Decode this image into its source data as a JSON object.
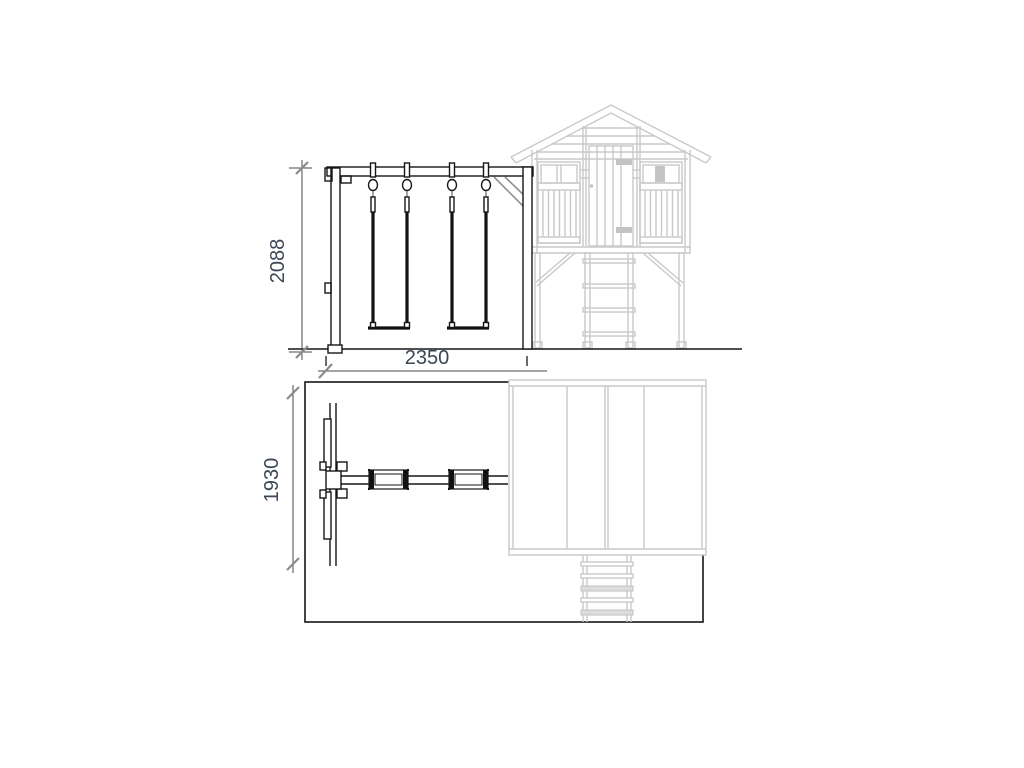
{
  "drawing": {
    "dimensions": {
      "elevation_height": {
        "value": "2088",
        "unit_hint": "mm",
        "orientation": "vertical"
      },
      "elevation_width": {
        "value": "2350",
        "unit_hint": "mm",
        "orientation": "horizontal"
      },
      "plan_depth": {
        "value": "1930",
        "unit_hint": "mm",
        "orientation": "vertical"
      }
    },
    "colors": {
      "structure_line": "#161616",
      "playhouse_line": "#c9c9c9",
      "corner_brace": "#8f8f8f",
      "dimension_text": "#3b4754",
      "dimension_line": "#4a4a4a",
      "background": "#ffffff"
    }
  }
}
